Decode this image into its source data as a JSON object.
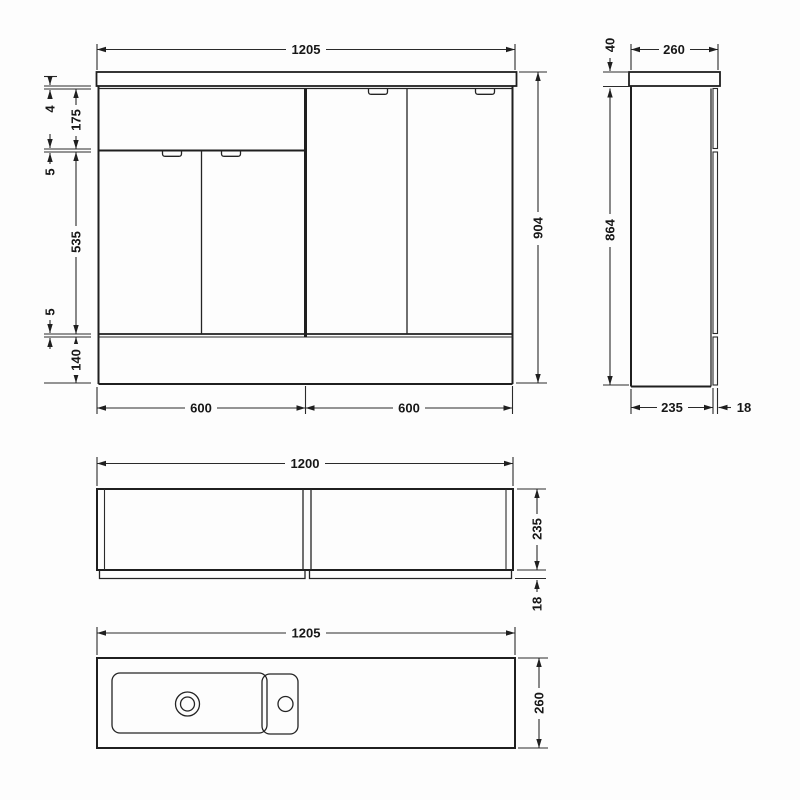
{
  "views": {
    "front": {
      "width": "1205",
      "height": "904",
      "left_stack": [
        "4",
        "175",
        "5",
        "535",
        "5",
        "140"
      ],
      "bottom_widths": [
        "600",
        "600"
      ]
    },
    "side": {
      "countertop_thickness": "40",
      "width": "260",
      "height": "864",
      "cabinet_depth": "235",
      "door_thickness": "18"
    },
    "plan": {
      "width": "1200",
      "depth": "235",
      "door_thickness": "18"
    },
    "counter_plan": {
      "width": "1205",
      "depth": "260"
    }
  }
}
